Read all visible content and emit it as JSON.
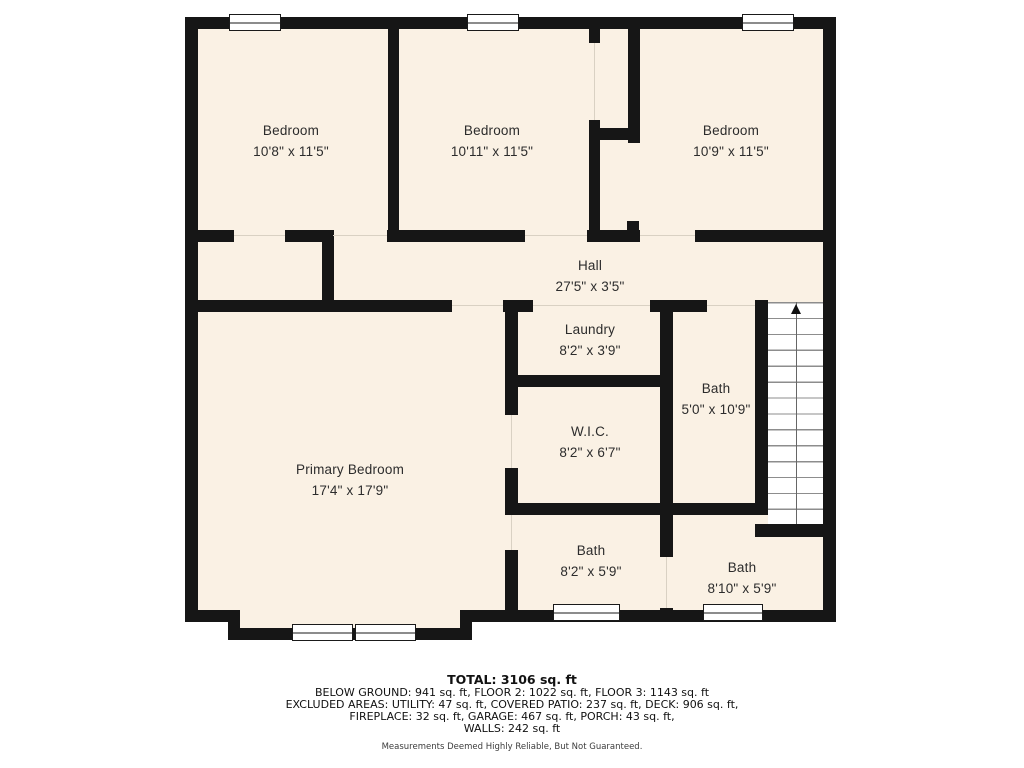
{
  "floorplan": {
    "rooms": [
      {
        "id": "bedroom-1",
        "name": "Bedroom",
        "dims": "10'8\" x 11'5\""
      },
      {
        "id": "bedroom-2",
        "name": "Bedroom",
        "dims": "10'11\" x 11'5\""
      },
      {
        "id": "bedroom-3",
        "name": "Bedroom",
        "dims": "10'9\" x 11'5\""
      },
      {
        "id": "hall",
        "name": "Hall",
        "dims": "27'5\" x 3'5\""
      },
      {
        "id": "laundry",
        "name": "Laundry",
        "dims": "8'2\" x 3'9\""
      },
      {
        "id": "bath-upper",
        "name": "Bath",
        "dims": "5'0\" x 10'9\""
      },
      {
        "id": "wic",
        "name": "W.I.C.",
        "dims": "8'2\" x 6'7\""
      },
      {
        "id": "primary-bedroom",
        "name": "Primary Bedroom",
        "dims": "17'4\" x 17'9\""
      },
      {
        "id": "bath-left",
        "name": "Bath",
        "dims": "8'2\" x 5'9\""
      },
      {
        "id": "bath-right",
        "name": "Bath",
        "dims": "8'10\" x 5'9\""
      }
    ],
    "stairs": {
      "direction": "up"
    }
  },
  "summary": {
    "total": "TOTAL: 3106 sq. ft",
    "floors": "BELOW GROUND: 941 sq. ft, FLOOR 2: 1022 sq. ft, FLOOR 3: 1143 sq. ft",
    "excluded_1": "EXCLUDED AREAS: UTILITY: 47 sq. ft, COVERED PATIO: 237 sq. ft, DECK: 906 sq. ft,",
    "excluded_2": "FIREPLACE: 32 sq. ft, GARAGE: 467 sq. ft, PORCH: 43 sq. ft,",
    "walls": "WALLS: 242 sq. ft",
    "disclaimer": "Measurements Deemed Highly Reliable, But Not Guaranteed."
  },
  "colors": {
    "room_fill": "#FAF1E4",
    "wall": "#161616",
    "background": "#FFFFFF"
  }
}
